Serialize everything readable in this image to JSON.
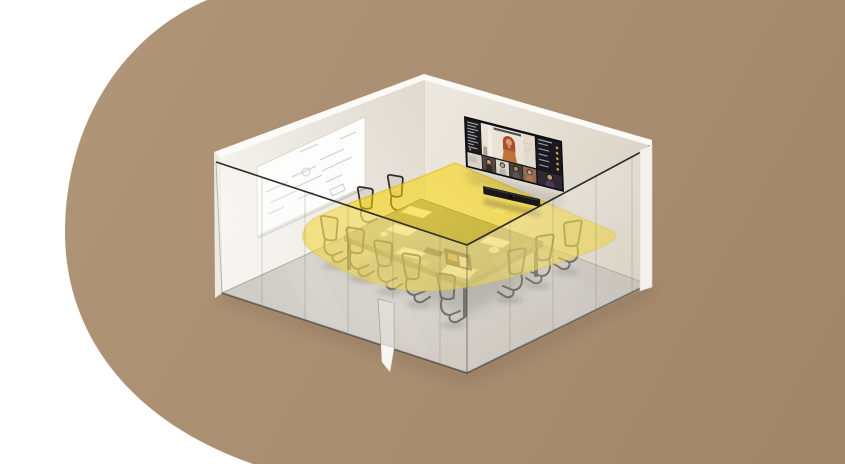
{
  "scene": {
    "title": "Isometric glass-walled meeting room with wall-mounted video conference display, video bar and yellow audio coverage zone over the conference table",
    "room": {
      "whiteboard": "whiteboard with faint sketches",
      "display": "wall-mounted video meeting screen",
      "video_bar": "all-in-one video bar below display",
      "coverage_zone": "audio pickup coverage area",
      "door": "glass door ajar at front wall",
      "table": "rectangular conference table",
      "chair_count": 10
    },
    "display_ui": {
      "left_panel_lines": 9,
      "participant_tiles": 5,
      "roster_rows": 5
    }
  },
  "colors": {
    "page_background": "#ffffff",
    "blob_light": "#b19678",
    "blob_dark": "#a2866a",
    "floor_light": "#d3cfc7",
    "floor_dark": "#b9b5ad",
    "wall_left_light": "#f6f4ef",
    "wall_left_shade": "#e1dbd1",
    "wall_right_light": "#ece7de",
    "wall_right_shade": "#d8d0c2",
    "wall_top": "#fbfaf7",
    "whiteboard": "#fdfdfb",
    "table_top_light": "#a6a49b",
    "table_top_dark": "#8d8b82",
    "chair_frame": "#2d2c29",
    "coverage_core": "#ffdb00",
    "coverage_edge": "#eec800",
    "tv_bezel": "#0c0c0f",
    "video_bar": "#17171a",
    "avatar_accent": "#e2a93c",
    "glass_top_frame": "#2e2b26"
  }
}
